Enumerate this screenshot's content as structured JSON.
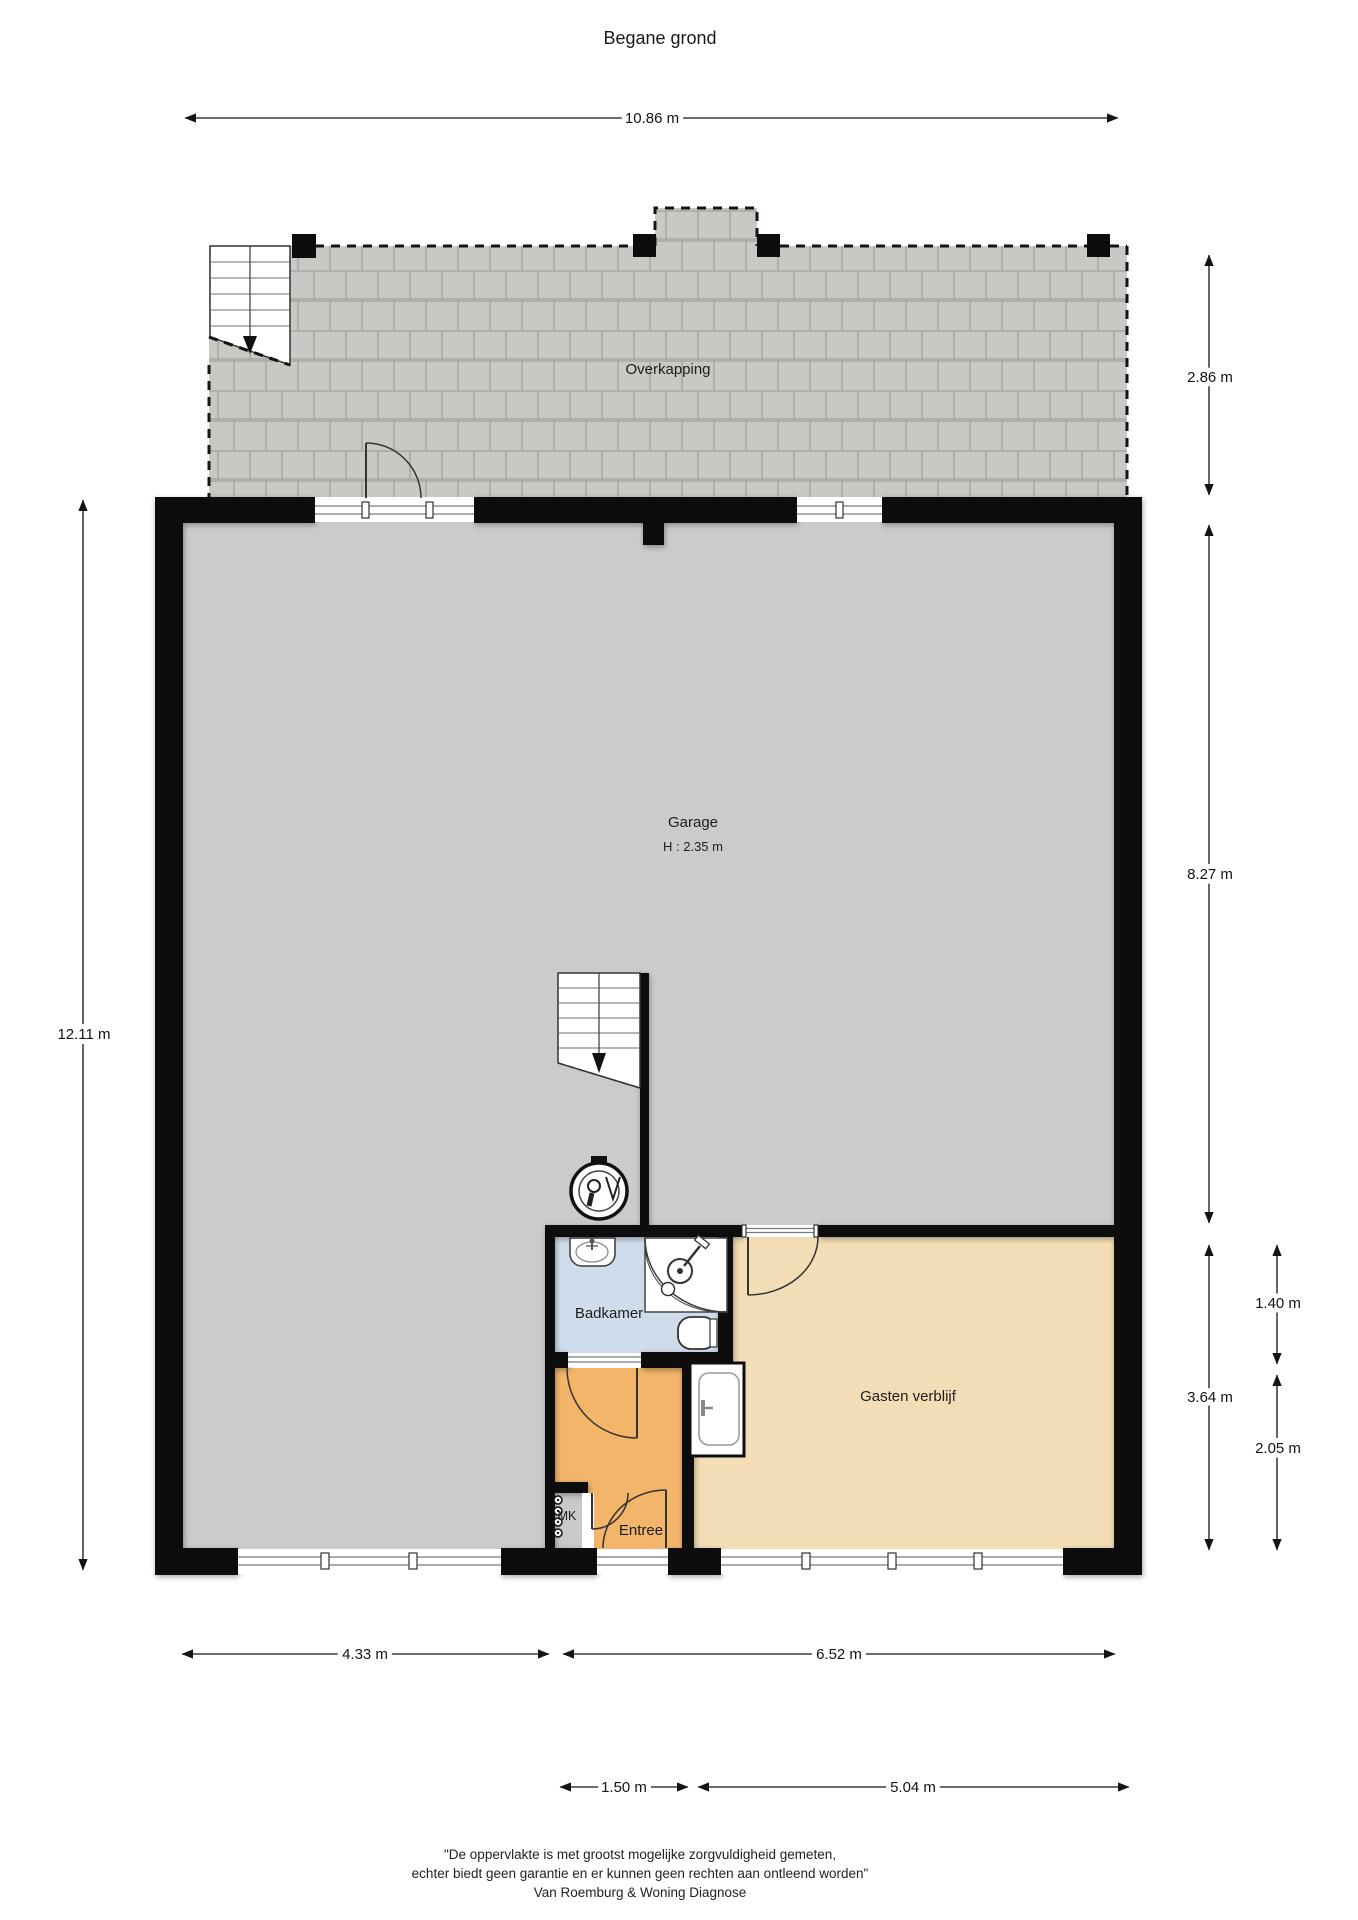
{
  "title": "Begane grond",
  "rooms": {
    "overkapping": {
      "label": "Overkapping"
    },
    "garage": {
      "label": "Garage",
      "height": "H : 2.35 m"
    },
    "badkamer": {
      "label": "Badkamer"
    },
    "gasten_verblijf": {
      "label": "Gasten verblijf"
    },
    "entree": {
      "label": "Entree"
    },
    "meterkast": {
      "label": "MK"
    }
  },
  "dimensions": {
    "top_width": "10.86 m",
    "left_height": "12.11 m",
    "right_overkapping": "2.86 m",
    "right_garage": "8.27 m",
    "right_lower_section": "3.64 m",
    "right_badkamer": "1.40 m",
    "right_entree": "2.05 m",
    "bottom_garage": "4.33 m",
    "bottom_right_section": "6.52 m",
    "bottom_entree": "1.50 m",
    "bottom_gasten": "5.04 m"
  },
  "footer": {
    "line1": "\"De oppervlakte is met grootst mogelijke zorgvuldigheid gemeten,",
    "line2": "echter biedt geen garantie en er kunnen geen rechten aan ontleend worden\"",
    "line3": "Van Roemburg & Woning Diagnose"
  },
  "colors": {
    "wall": "#0d0d0d",
    "garage_floor": "#cbcbcb",
    "badkamer_floor": "#cfdceb",
    "entree_floor": "#f2b569",
    "gasten_floor": "#f3ddb6",
    "meterkast_floor": "#c9c9c9",
    "paving": "#c8c8c4"
  }
}
